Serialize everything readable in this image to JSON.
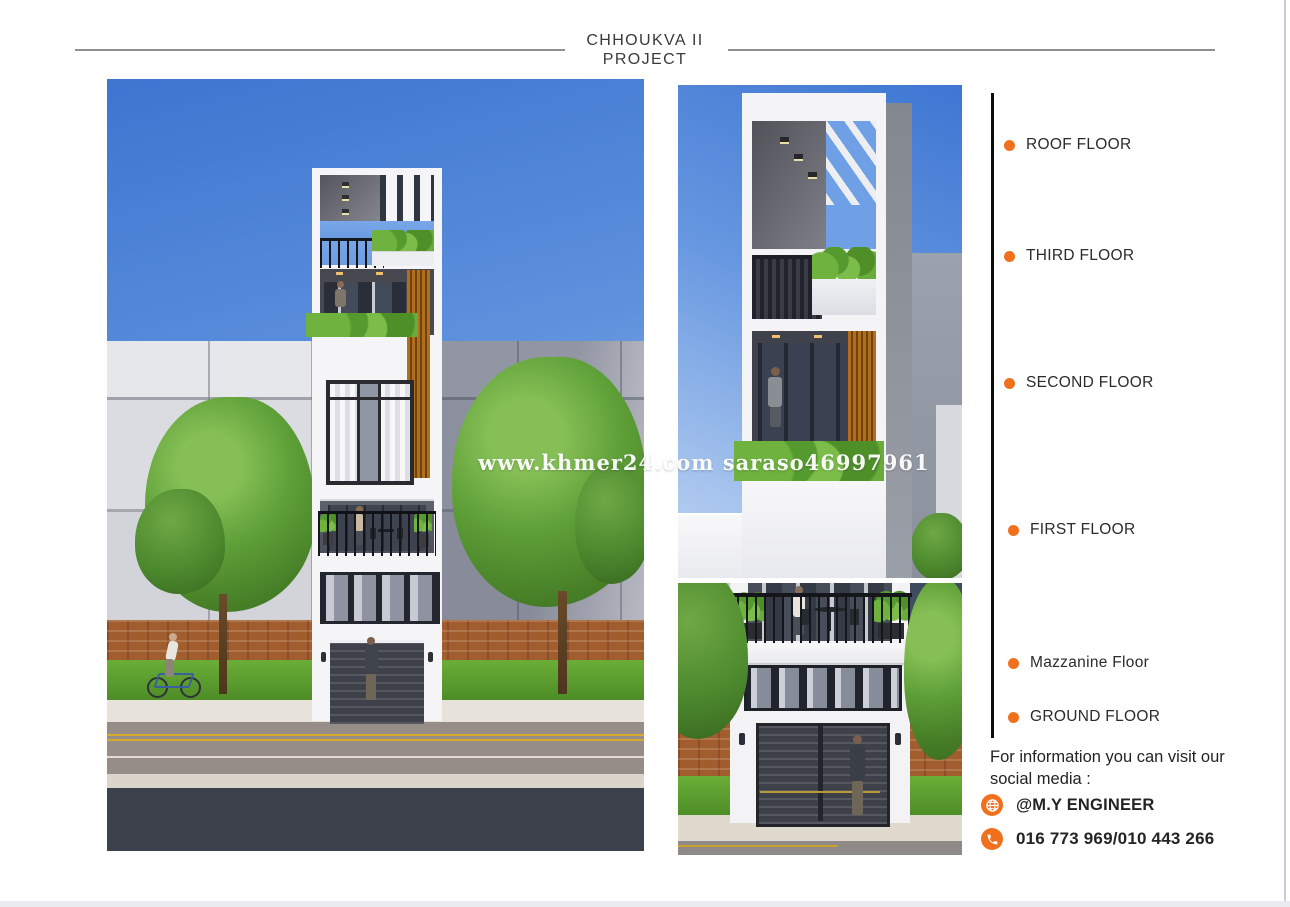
{
  "header": {
    "title_line1": "CHHOUKVA II",
    "title_line2": "PROJECT"
  },
  "floor_labels": [
    {
      "label": "ROOF FLOOR"
    },
    {
      "label": "THIRD FLOOR"
    },
    {
      "label": "SECOND FLOOR"
    },
    {
      "label": "FIRST FLOOR"
    },
    {
      "label": "Mazzanine Floor"
    },
    {
      "label": "GROUND FLOOR"
    }
  ],
  "footer": {
    "info_line1": "For information you can visit our",
    "info_line2": "social media :",
    "social_handle": "@M.Y ENGINEER",
    "phone_numbers": "016 773 969/010 443 266"
  },
  "watermark": {
    "text": "www.khmer24.com saraso46997961"
  },
  "icons": {
    "globe": "globe-icon",
    "phone": "phone-icon"
  },
  "colors": {
    "accent_orange": "#F1701D",
    "timeline_black": "#0B0B0B",
    "rule_gray": "#8F8F93"
  }
}
